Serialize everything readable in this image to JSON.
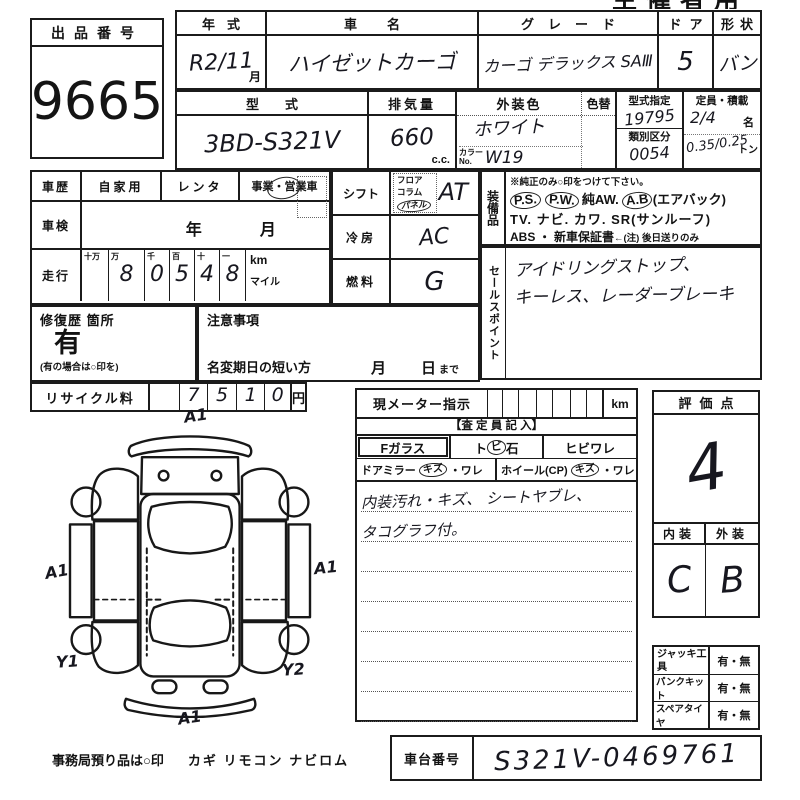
{
  "corner": {
    "header": "主催者用"
  },
  "auction_no": {
    "label": "出品番号",
    "value": "9665"
  },
  "year": {
    "label": "年式",
    "value": "R2/11",
    "unit": "月"
  },
  "car_name": {
    "label": "車名",
    "value": "ハイゼットカーゴ"
  },
  "grade": {
    "label": "グレード",
    "value": "カーゴ デラックス SAⅢ"
  },
  "doors": {
    "label": "ドア",
    "value": "5"
  },
  "shape": {
    "label": "形状",
    "value": "バン"
  },
  "model": {
    "label": "型式",
    "value": "3BD-S321V"
  },
  "displacement": {
    "label": "排気量",
    "value": "660",
    "unit": "c.c."
  },
  "color": {
    "label": "外装色",
    "change_label": "色替",
    "value": "ホワイト",
    "no_label": "カラーNo.",
    "no_value": "W19"
  },
  "type_no": {
    "label": "型式指定",
    "value": "19795",
    "class_label": "類別区分",
    "class_value": "0054"
  },
  "capacity": {
    "label": "定員・積載",
    "persons": "2/4",
    "persons_unit": "名",
    "load": "0.35/0.25",
    "load_unit": "トン"
  },
  "history": {
    "label": "車歴",
    "opt1": "自家用",
    "opt2": "レンタ",
    "opt3": "事業・営業車"
  },
  "inspection": {
    "label": "車検",
    "year_label": "年",
    "month_label": "月"
  },
  "mileage": {
    "label": "走行",
    "headers": [
      "十万",
      "万",
      "千",
      "百",
      "十",
      "一"
    ],
    "digits": [
      "",
      "8",
      "0",
      "5",
      "4",
      "8"
    ],
    "unit_km": "km",
    "unit_mile": "マイル"
  },
  "shift": {
    "label": "シフト",
    "opt1": "フロア",
    "opt2": "コラム",
    "opt3": "パネル",
    "value": "AT"
  },
  "aircon": {
    "label": "冷房",
    "value": "AC"
  },
  "fuel": {
    "label": "燃料",
    "value": "G"
  },
  "equipment": {
    "label": "装備品",
    "note": "※純正のみ○印をつけて下さい。",
    "ps": "P.S.",
    "pw": "P.W.",
    "aw": "純AW.",
    "ab": "A.B",
    "ab_suffix": "(エアバック)",
    "line2": "TV. ナビ. カワ. SR(サンルーフ)",
    "line3": "ABS ・ 新車保証書",
    "line3_note": "←(注) 後日送りのみ"
  },
  "sales_point": {
    "label": "セールスポイント",
    "line1": "アイドリングストップ、",
    "line2": "キーレス、レーダーブレーキ"
  },
  "repair": {
    "label": "修復歴 箇所",
    "value": "有",
    "note": "(有の場合は○印を)"
  },
  "caution": {
    "label": "注意事項",
    "rename": "名変期日の短い方",
    "month": "月",
    "day": "日",
    "until": "まで"
  },
  "recycle": {
    "label": "リサイクル料",
    "digits": [
      "7",
      "5",
      "1",
      "0"
    ],
    "unit": "円"
  },
  "diagram": {
    "mark_top": "A1",
    "mark_left": "A1",
    "mark_right": "A1",
    "mark_bottom": "A1",
    "mark_bl": "Y1",
    "mark_br": "Y2"
  },
  "office": {
    "label": "事務局預り品は○印",
    "items": "カギ リモコン ナビロム"
  },
  "meter": {
    "label": "現メーター指示",
    "unit": "km",
    "assessor": "【査 定 員 記 入】",
    "glass_f": "Fガラス",
    "tobi_a": "ト",
    "tobi_b": "ビ",
    "tobi_c": "石",
    "hibi": "ヒビワレ",
    "mirror": "ドアミラー",
    "kizu": "キズ",
    "ware": "・ワレ",
    "wheel": "ホイール(CP)",
    "note1": "内装汚れ・キズ、 シートヤブレ、",
    "note2": "タコグラフ付。"
  },
  "score": {
    "label": "評価点",
    "value": "4",
    "int_label": "内装",
    "ext_label": "外装",
    "interior": "C",
    "exterior": "B"
  },
  "accessories": {
    "jack": "ジャッキ工具",
    "jack_v": "有・無",
    "pank": "パンクキット",
    "pank_v": "有・無",
    "spare": "スペアタイヤ",
    "spare_v": "有・無"
  },
  "chassis": {
    "label": "車台番号",
    "value": "S321V-0469761"
  }
}
